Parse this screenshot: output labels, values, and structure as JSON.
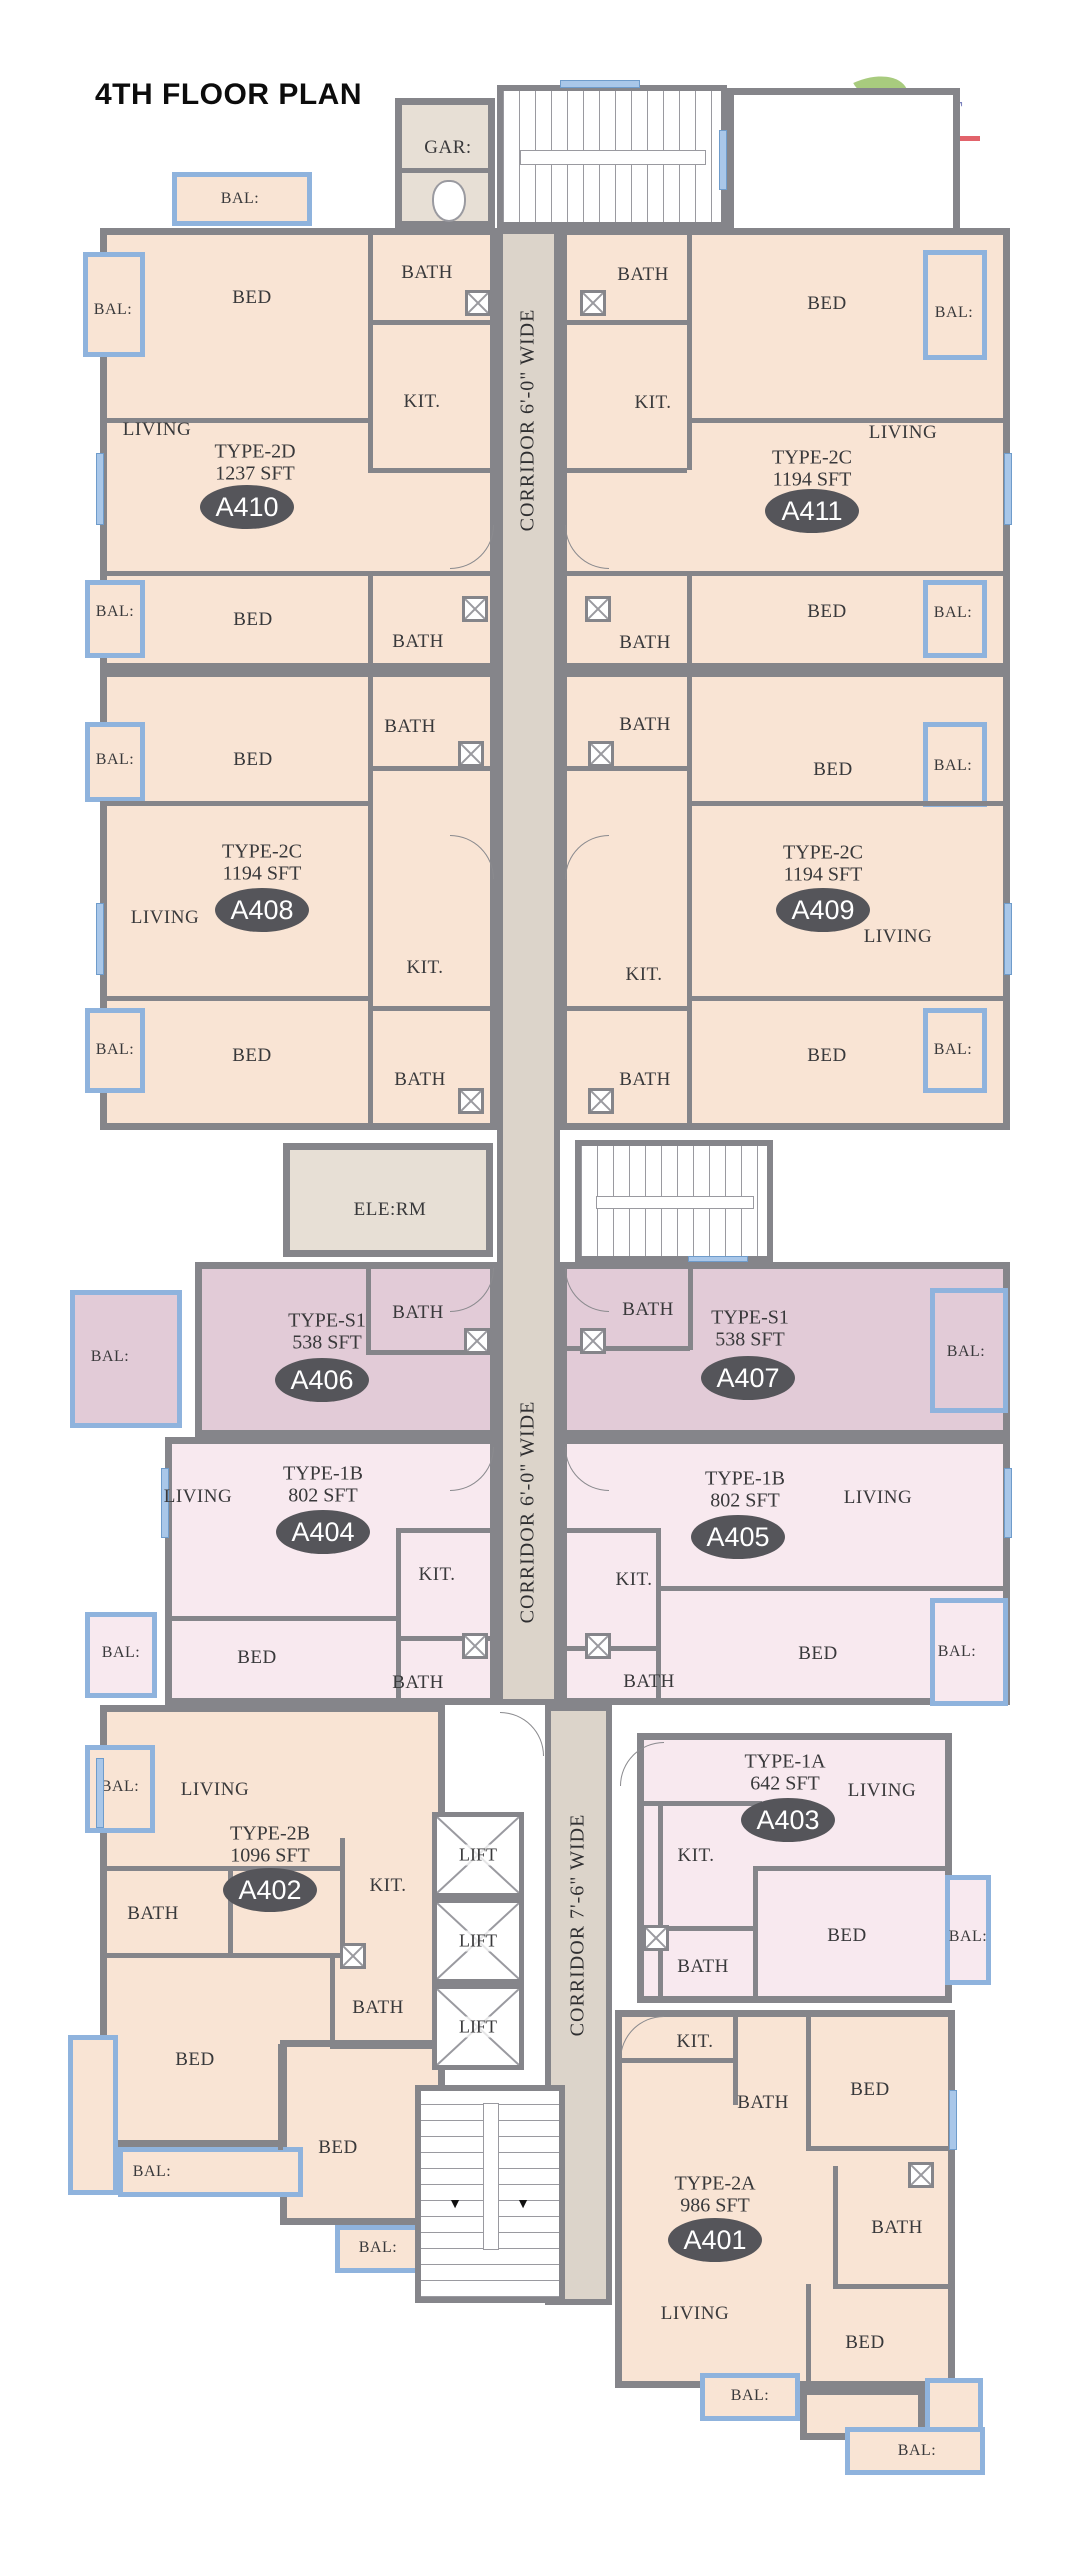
{
  "title": "4TH FLOOR PLAN",
  "logo": {
    "brand": "The Springs JT",
    "tagline": "Apartment Homes"
  },
  "palette": {
    "wall": "#85858a",
    "peach": "#f9e4d4",
    "mauve": "#e2cbd7",
    "pink": "#f8e9ef",
    "corridor": "#dcd4ca",
    "greige": "#e7dfd5",
    "balcony_blue": "#8fb3dd",
    "oval": "#55555a",
    "text": "#39393b",
    "logo_purple": "#7b82bd",
    "logo_red": "#e2636b",
    "leaf_green": "#a8cb7e",
    "white": "#ffffff"
  },
  "units": [
    {
      "id": "A410",
      "unit_type": "TYPE-2D",
      "area": "1237 SFT",
      "cx": 247,
      "cy": 507,
      "tx": 255,
      "ty": 452
    },
    {
      "id": "A411",
      "unit_type": "TYPE-2C",
      "area": "1194 SFT",
      "cx": 812,
      "cy": 511,
      "tx": 812,
      "ty": 458
    },
    {
      "id": "A408",
      "unit_type": "TYPE-2C",
      "area": "1194 SFT",
      "cx": 262,
      "cy": 910,
      "tx": 262,
      "ty": 852
    },
    {
      "id": "A409",
      "unit_type": "TYPE-2C",
      "area": "1194 SFT",
      "cx": 823,
      "cy": 910,
      "tx": 823,
      "ty": 853
    },
    {
      "id": "A406",
      "unit_type": "TYPE-S1",
      "area": "538 SFT",
      "cx": 322,
      "cy": 1380,
      "tx": 327,
      "ty": 1321
    },
    {
      "id": "A407",
      "unit_type": "TYPE-S1",
      "area": "538 SFT",
      "cx": 748,
      "cy": 1378,
      "tx": 750,
      "ty": 1318
    },
    {
      "id": "A404",
      "unit_type": "TYPE-1B",
      "area": "802 SFT",
      "cx": 323,
      "cy": 1532,
      "tx": 323,
      "ty": 1474
    },
    {
      "id": "A405",
      "unit_type": "TYPE-1B",
      "area": "802 SFT",
      "cx": 738,
      "cy": 1537,
      "tx": 745,
      "ty": 1479
    },
    {
      "id": "A402",
      "unit_type": "TYPE-2B",
      "area": "1096 SFT",
      "cx": 270,
      "cy": 1890,
      "tx": 270,
      "ty": 1834
    },
    {
      "id": "A403",
      "unit_type": "TYPE-1A",
      "area": "642 SFT",
      "cx": 788,
      "cy": 1820,
      "tx": 785,
      "ty": 1762
    },
    {
      "id": "A401",
      "unit_type": "TYPE-2A",
      "area": "986 SFT",
      "cx": 715,
      "cy": 2240,
      "tx": 715,
      "ty": 2184
    }
  ],
  "blocks": [
    {
      "name": "unit-a410",
      "x": 100,
      "y": 228,
      "w": 397,
      "h": 442,
      "fill": "peach"
    },
    {
      "name": "unit-a411",
      "x": 560,
      "y": 228,
      "w": 450,
      "h": 442,
      "fill": "peach"
    },
    {
      "name": "top-lobby",
      "x": 727,
      "y": 88,
      "w": 233,
      "h": 147,
      "fill": "white"
    },
    {
      "name": "unit-a408",
      "x": 100,
      "y": 670,
      "w": 397,
      "h": 460,
      "fill": "peach"
    },
    {
      "name": "unit-a409",
      "x": 560,
      "y": 670,
      "w": 450,
      "h": 460,
      "fill": "peach"
    },
    {
      "name": "unit-a406",
      "x": 195,
      "y": 1262,
      "w": 302,
      "h": 175,
      "fill": "mauve"
    },
    {
      "name": "unit-a407",
      "x": 560,
      "y": 1262,
      "w": 450,
      "h": 175,
      "fill": "mauve"
    },
    {
      "name": "unit-a404",
      "x": 165,
      "y": 1437,
      "w": 332,
      "h": 268,
      "fill": "pink"
    },
    {
      "name": "unit-a405",
      "x": 560,
      "y": 1437,
      "w": 450,
      "h": 268,
      "fill": "pink"
    },
    {
      "name": "unit-a402",
      "x": 100,
      "y": 1705,
      "w": 345,
      "h": 442,
      "fill": "peach"
    },
    {
      "name": "unit-a402-ext",
      "x": 280,
      "y": 2040,
      "w": 165,
      "h": 185,
      "fill": "peach"
    },
    {
      "name": "unit-a403",
      "x": 637,
      "y": 1733,
      "w": 315,
      "h": 270,
      "fill": "pink"
    },
    {
      "name": "unit-a401",
      "x": 615,
      "y": 2010,
      "w": 340,
      "h": 378,
      "fill": "peach"
    },
    {
      "name": "unit-a401-ext",
      "x": 800,
      "y": 2388,
      "w": 125,
      "h": 52,
      "fill": "peach"
    },
    {
      "name": "garbage-room",
      "x": 395,
      "y": 98,
      "w": 100,
      "h": 130,
      "fill": "greige"
    },
    {
      "name": "electrical-room",
      "x": 283,
      "y": 1143,
      "w": 210,
      "h": 114,
      "fill": "greige"
    }
  ],
  "corridor_strips": [
    {
      "name": "corridor-upper",
      "x": 497,
      "y": 228,
      "w": 63,
      "h": 1477
    },
    {
      "name": "corridor-lower",
      "x": 545,
      "y": 1705,
      "w": 67,
      "h": 600
    }
  ],
  "corridor_labels": [
    {
      "text": "CORRIDOR 6'-0\" WIDE",
      "x": 528,
      "y": 420
    },
    {
      "text": "CORRIDOR 6'-0\" WIDE",
      "x": 528,
      "y": 1512
    },
    {
      "text": "CORRIDOR 7'-6\" WIDE",
      "x": 578,
      "y": 1925
    }
  ],
  "room_labels": [
    {
      "text": "GAR:",
      "x": 448,
      "y": 148
    },
    {
      "text": "BED",
      "x": 252,
      "y": 298
    },
    {
      "text": "BATH",
      "x": 427,
      "y": 273
    },
    {
      "text": "KIT.",
      "x": 422,
      "y": 402
    },
    {
      "text": "LIVING",
      "x": 157,
      "y": 430
    },
    {
      "text": "BED",
      "x": 253,
      "y": 620
    },
    {
      "text": "BATH",
      "x": 418,
      "y": 642
    },
    {
      "text": "BATH",
      "x": 643,
      "y": 275
    },
    {
      "text": "BED",
      "x": 827,
      "y": 304
    },
    {
      "text": "KIT.",
      "x": 653,
      "y": 403
    },
    {
      "text": "LIVING",
      "x": 903,
      "y": 433
    },
    {
      "text": "BED",
      "x": 827,
      "y": 612
    },
    {
      "text": "BATH",
      "x": 645,
      "y": 643
    },
    {
      "text": "BATH",
      "x": 410,
      "y": 727
    },
    {
      "text": "BED",
      "x": 253,
      "y": 760
    },
    {
      "text": "LIVING",
      "x": 165,
      "y": 918
    },
    {
      "text": "KIT.",
      "x": 425,
      "y": 968
    },
    {
      "text": "BED",
      "x": 252,
      "y": 1056
    },
    {
      "text": "BATH",
      "x": 420,
      "y": 1080
    },
    {
      "text": "BATH",
      "x": 645,
      "y": 725
    },
    {
      "text": "BED",
      "x": 833,
      "y": 770
    },
    {
      "text": "LIVING",
      "x": 898,
      "y": 937
    },
    {
      "text": "KIT.",
      "x": 644,
      "y": 975
    },
    {
      "text": "BED",
      "x": 827,
      "y": 1056
    },
    {
      "text": "BATH",
      "x": 645,
      "y": 1080
    },
    {
      "text": "ELE:RM",
      "x": 390,
      "y": 1210
    },
    {
      "text": "BATH",
      "x": 418,
      "y": 1313
    },
    {
      "text": "BATH",
      "x": 648,
      "y": 1310
    },
    {
      "text": "LIVING",
      "x": 198,
      "y": 1497
    },
    {
      "text": "KIT.",
      "x": 437,
      "y": 1575
    },
    {
      "text": "BED",
      "x": 257,
      "y": 1658
    },
    {
      "text": "BATH",
      "x": 418,
      "y": 1683
    },
    {
      "text": "LIVING",
      "x": 878,
      "y": 1498
    },
    {
      "text": "KIT.",
      "x": 634,
      "y": 1580
    },
    {
      "text": "BED",
      "x": 818,
      "y": 1654
    },
    {
      "text": "BATH",
      "x": 649,
      "y": 1682
    },
    {
      "text": "LIVING",
      "x": 215,
      "y": 1790
    },
    {
      "text": "KIT.",
      "x": 388,
      "y": 1886
    },
    {
      "text": "BATH",
      "x": 153,
      "y": 1914
    },
    {
      "text": "BATH",
      "x": 378,
      "y": 2008
    },
    {
      "text": "BED",
      "x": 195,
      "y": 2060
    },
    {
      "text": "BED",
      "x": 338,
      "y": 2148
    },
    {
      "text": "LIVING",
      "x": 882,
      "y": 1791
    },
    {
      "text": "KIT.",
      "x": 696,
      "y": 1856
    },
    {
      "text": "BED",
      "x": 847,
      "y": 1936
    },
    {
      "text": "BATH",
      "x": 703,
      "y": 1967
    },
    {
      "text": "KIT.",
      "x": 695,
      "y": 2042
    },
    {
      "text": "BATH",
      "x": 763,
      "y": 2103
    },
    {
      "text": "BED",
      "x": 870,
      "y": 2090
    },
    {
      "text": "BATH",
      "x": 897,
      "y": 2228
    },
    {
      "text": "LIVING",
      "x": 695,
      "y": 2314
    },
    {
      "text": "BED",
      "x": 865,
      "y": 2343
    }
  ],
  "balconies": [
    {
      "x": 172,
      "y": 172,
      "w": 140,
      "h": 54,
      "label": "BAL:",
      "lx": 240,
      "ly": 199,
      "fill": "peach"
    },
    {
      "x": 83,
      "y": 252,
      "w": 62,
      "h": 105,
      "label": "BAL:",
      "lx": 113,
      "ly": 310,
      "fill": "peach"
    },
    {
      "x": 923,
      "y": 250,
      "w": 64,
      "h": 110,
      "label": "BAL:",
      "lx": 954,
      "ly": 313,
      "fill": "peach"
    },
    {
      "x": 85,
      "y": 580,
      "w": 60,
      "h": 78,
      "label": "BAL:",
      "lx": 115,
      "ly": 612,
      "fill": "peach"
    },
    {
      "x": 923,
      "y": 580,
      "w": 64,
      "h": 78,
      "label": "BAL:",
      "lx": 953,
      "ly": 613,
      "fill": "peach"
    },
    {
      "x": 85,
      "y": 722,
      "w": 60,
      "h": 80,
      "label": "BAL:",
      "lx": 115,
      "ly": 760,
      "fill": "peach"
    },
    {
      "x": 923,
      "y": 722,
      "w": 64,
      "h": 85,
      "label": "BAL:",
      "lx": 953,
      "ly": 766,
      "fill": "peach"
    },
    {
      "x": 85,
      "y": 1008,
      "w": 60,
      "h": 85,
      "label": "BAL:",
      "lx": 115,
      "ly": 1050,
      "fill": "peach"
    },
    {
      "x": 923,
      "y": 1008,
      "w": 64,
      "h": 85,
      "label": "BAL:",
      "lx": 953,
      "ly": 1050,
      "fill": "peach"
    },
    {
      "x": 70,
      "y": 1290,
      "w": 112,
      "h": 138,
      "label": "BAL:",
      "lx": 110,
      "ly": 1357,
      "fill": "mauve"
    },
    {
      "x": 930,
      "y": 1288,
      "w": 78,
      "h": 125,
      "label": "BAL:",
      "lx": 966,
      "ly": 1352,
      "fill": "mauve"
    },
    {
      "x": 85,
      "y": 1612,
      "w": 72,
      "h": 86,
      "label": "BAL:",
      "lx": 121,
      "ly": 1653,
      "fill": "pink"
    },
    {
      "x": 930,
      "y": 1598,
      "w": 78,
      "h": 108,
      "label": "BAL:",
      "lx": 957,
      "ly": 1652,
      "fill": "pink"
    },
    {
      "x": 85,
      "y": 1745,
      "w": 70,
      "h": 88,
      "label": "BAL:",
      "lx": 120,
      "ly": 1787,
      "fill": "peach"
    },
    {
      "x": 68,
      "y": 2035,
      "w": 50,
      "h": 160,
      "label": "",
      "lx": 0,
      "ly": 0,
      "fill": "peach"
    },
    {
      "x": 118,
      "y": 2147,
      "w": 185,
      "h": 50,
      "label": "BAL:",
      "lx": 152,
      "ly": 2172,
      "fill": "peach"
    },
    {
      "x": 335,
      "y": 2225,
      "w": 85,
      "h": 48,
      "label": "BAL:",
      "lx": 378,
      "ly": 2248,
      "fill": "peach"
    },
    {
      "x": 945,
      "y": 1875,
      "w": 46,
      "h": 110,
      "label": "BAL:",
      "lx": 968,
      "ly": 1937,
      "fill": "pink"
    },
    {
      "x": 700,
      "y": 2373,
      "w": 100,
      "h": 48,
      "label": "BAL:",
      "lx": 750,
      "ly": 2396,
      "fill": "peach"
    },
    {
      "x": 925,
      "y": 2378,
      "w": 58,
      "h": 55,
      "label": "",
      "lx": 0,
      "ly": 0,
      "fill": "peach"
    },
    {
      "x": 845,
      "y": 2427,
      "w": 140,
      "h": 48,
      "label": "BAL:",
      "lx": 917,
      "ly": 2451,
      "fill": "peach"
    }
  ],
  "walls": [
    [
      368,
      228,
      5,
      242
    ],
    [
      368,
      320,
      129,
      5
    ],
    [
      100,
      418,
      272,
      5
    ],
    [
      368,
      468,
      129,
      5
    ],
    [
      100,
      571,
      397,
      5
    ],
    [
      368,
      571,
      5,
      99
    ],
    [
      687,
      228,
      5,
      242
    ],
    [
      560,
      320,
      127,
      5
    ],
    [
      687,
      418,
      323,
      5
    ],
    [
      560,
      468,
      127,
      5
    ],
    [
      560,
      571,
      450,
      5
    ],
    [
      687,
      571,
      5,
      99
    ],
    [
      368,
      670,
      5,
      460
    ],
    [
      368,
      766,
      129,
      5
    ],
    [
      100,
      801,
      272,
      5
    ],
    [
      100,
      996,
      272,
      5
    ],
    [
      368,
      1006,
      129,
      5
    ],
    [
      687,
      670,
      5,
      460
    ],
    [
      560,
      766,
      127,
      5
    ],
    [
      687,
      801,
      323,
      5
    ],
    [
      687,
      996,
      323,
      5
    ],
    [
      560,
      1006,
      127,
      5
    ],
    [
      366,
      1262,
      5,
      93
    ],
    [
      366,
      1350,
      131,
      5
    ],
    [
      688,
      1262,
      5,
      88
    ],
    [
      560,
      1346,
      130,
      5
    ],
    [
      396,
      1528,
      101,
      5
    ],
    [
      396,
      1528,
      5,
      177
    ],
    [
      165,
      1616,
      233,
      5
    ],
    [
      396,
      1636,
      101,
      5
    ],
    [
      560,
      1528,
      101,
      5
    ],
    [
      656,
      1528,
      5,
      177
    ],
    [
      660,
      1586,
      350,
      5
    ],
    [
      560,
      1646,
      101,
      5
    ],
    [
      100,
      1866,
      243,
      5
    ],
    [
      340,
      1838,
      5,
      124
    ],
    [
      228,
      1866,
      5,
      92
    ],
    [
      100,
      1953,
      245,
      5
    ],
    [
      330,
      1956,
      5,
      92
    ],
    [
      330,
      2044,
      118,
      5
    ],
    [
      278,
      2044,
      5,
      106
    ],
    [
      753,
      1866,
      199,
      5
    ],
    [
      753,
      1866,
      5,
      137
    ],
    [
      658,
      1926,
      100,
      5
    ],
    [
      658,
      1801,
      5,
      202
    ],
    [
      637,
      1801,
      125,
      5
    ],
    [
      733,
      2010,
      5,
      95
    ],
    [
      615,
      2058,
      122,
      5
    ],
    [
      806,
      2010,
      5,
      140
    ],
    [
      806,
      2146,
      149,
      5
    ],
    [
      833,
      2166,
      5,
      122
    ],
    [
      833,
      2284,
      122,
      5
    ],
    [
      806,
      2284,
      5,
      104
    ],
    [
      395,
      168,
      100,
      5
    ]
  ],
  "stairs": [
    {
      "name": "stairs-top",
      "x": 497,
      "y": 85,
      "w": 230,
      "h": 143,
      "dir": "h",
      "arrows": ""
    },
    {
      "name": "stairs-middle",
      "x": 575,
      "y": 1140,
      "w": 198,
      "h": 122,
      "dir": "h",
      "arrows": ""
    },
    {
      "name": "stairs-bottom",
      "x": 415,
      "y": 2085,
      "w": 150,
      "h": 218,
      "dir": "v",
      "arrows": "down"
    }
  ],
  "lifts": [
    {
      "label": "LIFT",
      "x": 432,
      "y": 1812,
      "w": 92,
      "h": 86
    },
    {
      "label": "LIFT",
      "x": 432,
      "y": 1898,
      "w": 92,
      "h": 86
    },
    {
      "label": "LIFT",
      "x": 432,
      "y": 1984,
      "w": 92,
      "h": 86
    }
  ],
  "shafts": [
    [
      465,
      290
    ],
    [
      580,
      290
    ],
    [
      462,
      596
    ],
    [
      585,
      596
    ],
    [
      458,
      741
    ],
    [
      588,
      741
    ],
    [
      458,
      1088
    ],
    [
      588,
      1088
    ],
    [
      464,
      1328
    ],
    [
      580,
      1328
    ],
    [
      462,
      1633
    ],
    [
      585,
      1633
    ],
    [
      340,
      1943
    ],
    [
      643,
      1925
    ],
    [
      908,
      2162
    ]
  ],
  "doors": [
    {
      "x": 450,
      "y": 525,
      "corner": "br"
    },
    {
      "x": 565,
      "y": 525,
      "corner": "bl"
    },
    {
      "x": 450,
      "y": 835,
      "corner": "tr"
    },
    {
      "x": 565,
      "y": 835,
      "corner": "tl"
    },
    {
      "x": 450,
      "y": 1268,
      "corner": "br"
    },
    {
      "x": 565,
      "y": 1268,
      "corner": "bl"
    },
    {
      "x": 450,
      "y": 1447,
      "corner": "br"
    },
    {
      "x": 565,
      "y": 1447,
      "corner": "bl"
    },
    {
      "x": 500,
      "y": 1712,
      "corner": "tr"
    },
    {
      "x": 620,
      "y": 1742,
      "corner": "tl"
    },
    {
      "x": 620,
      "y": 2016,
      "corner": "tl"
    }
  ],
  "windows": [
    [
      560,
      80,
      80,
      8
    ],
    [
      719,
      130,
      8,
      60
    ],
    [
      688,
      1256,
      60,
      6
    ],
    [
      96,
      453,
      8,
      72
    ],
    [
      96,
      903,
      8,
      72
    ],
    [
      1004,
      453,
      8,
      72
    ],
    [
      1004,
      903,
      8,
      72
    ],
    [
      161,
      1468,
      8,
      70
    ],
    [
      1004,
      1468,
      8,
      70
    ],
    [
      96,
      1758,
      8,
      70
    ],
    [
      949,
      2090,
      8,
      60
    ]
  ],
  "stair_arrows": [
    {
      "glyph": "▼",
      "x": 455,
      "y": 2205
    },
    {
      "glyph": "▼",
      "x": 523,
      "y": 2205
    }
  ]
}
